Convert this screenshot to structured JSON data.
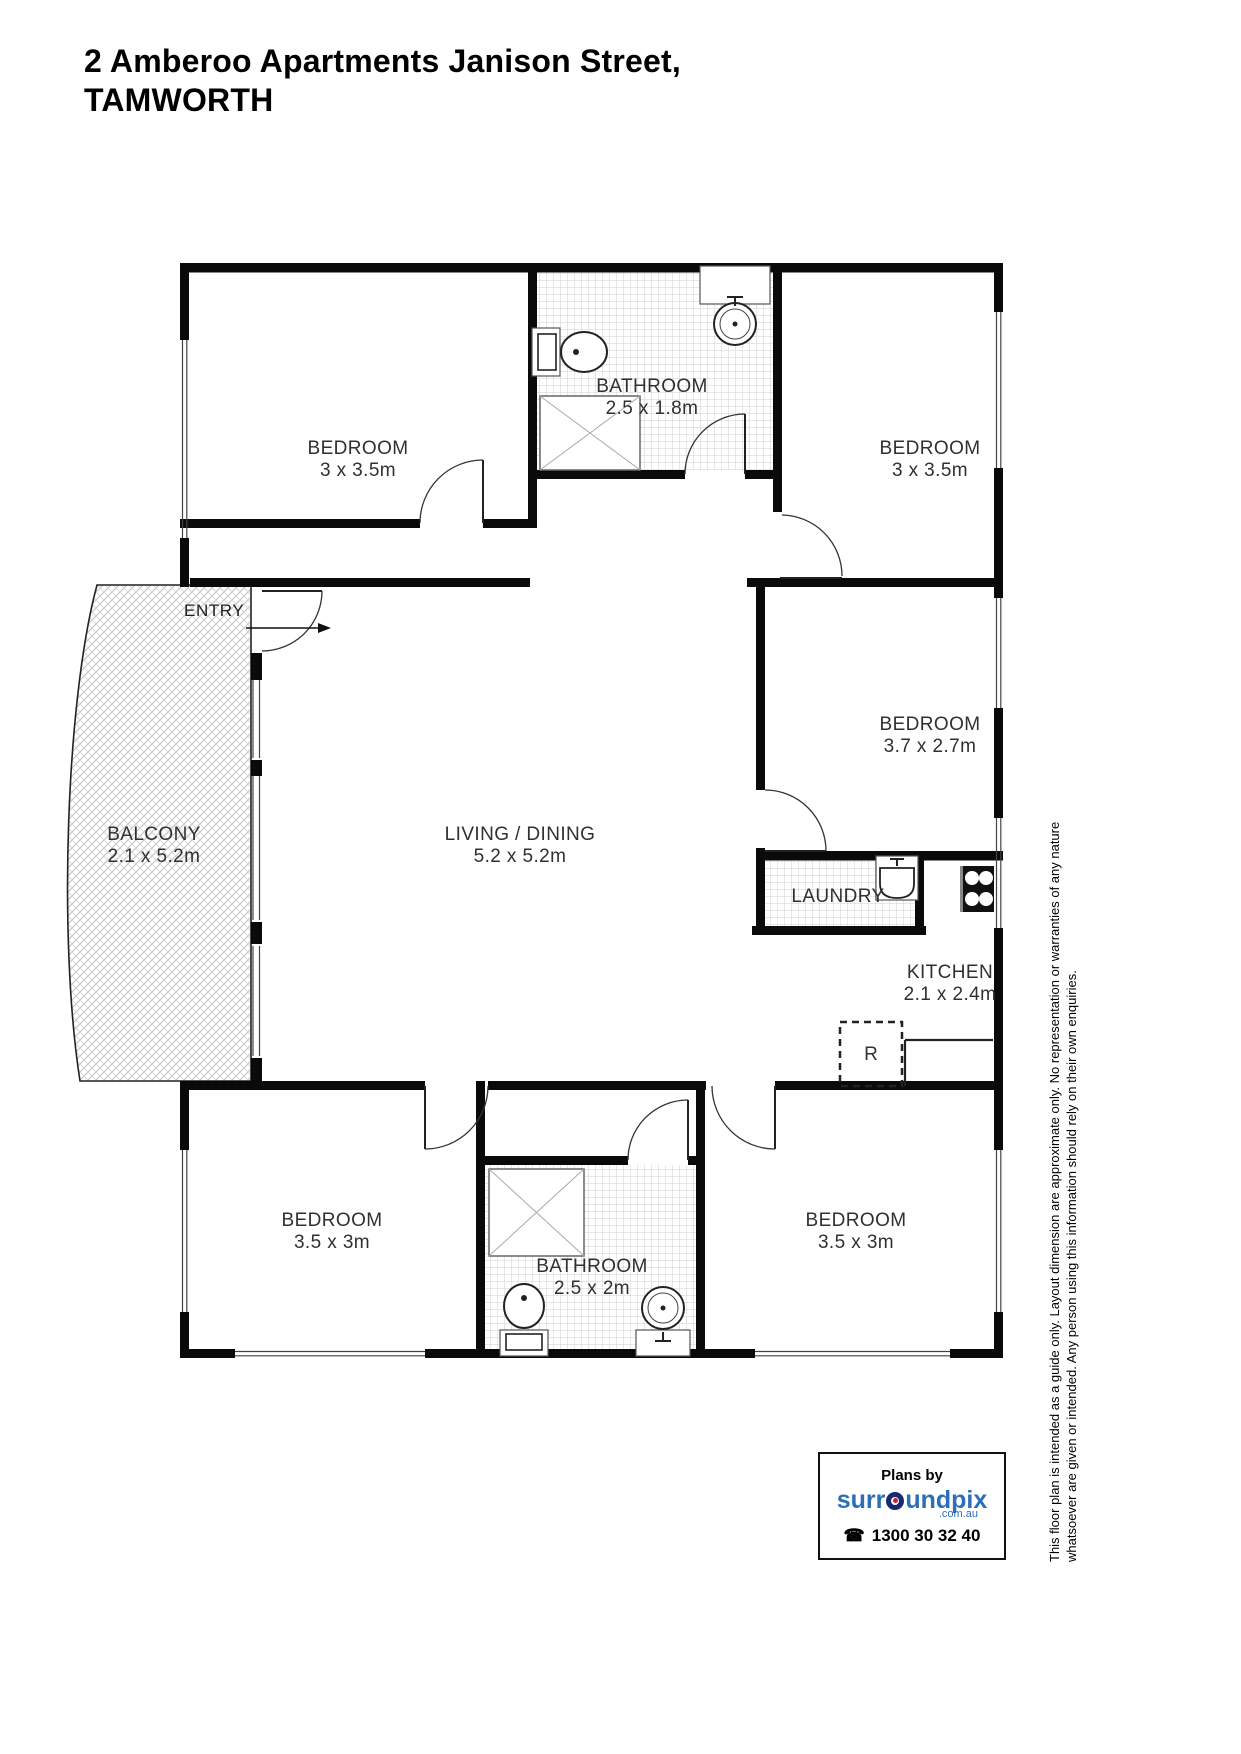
{
  "title": {
    "line1": "2 Amberoo Apartments Janison Street,",
    "line2": "TAMWORTH"
  },
  "rooms": {
    "bedroom_top_left": {
      "name": "BEDROOM",
      "dims": "3 x 3.5m"
    },
    "bathroom_top": {
      "name": "BATHROOM",
      "dims": "2.5 x 1.8m"
    },
    "bedroom_top_right": {
      "name": "BEDROOM",
      "dims": "3 x 3.5m"
    },
    "entry": {
      "name": "ENTRY"
    },
    "balcony": {
      "name": "BALCONY",
      "dims": "2.1 x 5.2m"
    },
    "living_dining": {
      "name": "LIVING / DINING",
      "dims": "5.2 x 5.2m"
    },
    "bedroom_right": {
      "name": "BEDROOM",
      "dims": "3.7 x 2.7m"
    },
    "laundry": {
      "name": "LAUNDRY"
    },
    "kitchen": {
      "name": "KITCHEN",
      "dims": "2.1 x 2.4m"
    },
    "refrigerator": {
      "label": "R"
    },
    "bedroom_bottom_left": {
      "name": "BEDROOM",
      "dims": "3.5 x 3m"
    },
    "bathroom_bottom": {
      "name": "BATHROOM",
      "dims": "2.5 x 2m"
    },
    "bedroom_bottom_right": {
      "name": "BEDROOM",
      "dims": "3.5 x 3m"
    }
  },
  "disclaimer": {
    "line1": "This floor plan is intended as a guide only. Layout dimension are approximate only. No representation or warranties of any nature",
    "line2": "whatsoever are given or intended. Any person using this information should rely on their own enquiries."
  },
  "branding": {
    "plans_by": "Plans by",
    "brand_part1": "surr",
    "brand_part2": "undpix",
    "brand_suffix": ".com.au",
    "phone": "1300 30 32 40",
    "brand_blue": "#2d6fb7",
    "brand_navy": "#152a70",
    "brand_red": "#cc2128"
  }
}
